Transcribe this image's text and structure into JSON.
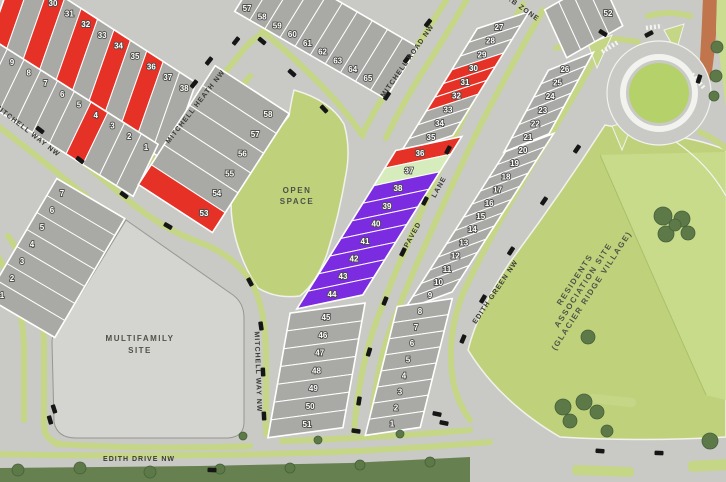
{
  "colors": {
    "red": "#e63226",
    "purple": "#7c2ce0",
    "pale": "#d7ecbc",
    "lot_gray": "#a9a9a6",
    "road_gray": "#c9c9c5",
    "verge_green": "#c5d687",
    "open_green": "#bfd27b",
    "field_light": "#cbdd90",
    "roundabout_green": "#b5d26a",
    "multifamily_gray": "#d4d4d0",
    "orange": "#c0754c",
    "tree_green": "#5e7948",
    "band_green": "#66804f"
  },
  "streets": [
    {
      "id": "mitchell-road-nw",
      "name": "MITCHELL ROAD NW"
    },
    {
      "id": "mitchell-heath-nw",
      "name": "MITCHELL HEATH NW"
    },
    {
      "id": "mitchell-way-nw-west",
      "name": "MITCHELL WAY NW"
    },
    {
      "id": "mitchell-way-nw-south",
      "name": "MITCHELL WAY NW"
    },
    {
      "id": "paved-lane",
      "name": "PAVED LANE"
    },
    {
      "id": "edith-green-nw",
      "name": "EDITH GREEN NW"
    },
    {
      "id": "edith-drive-nw",
      "name": "EDITH DRIVE NW"
    },
    {
      "id": "wb-zone",
      "name": "W.B ZONE"
    }
  ],
  "areas": [
    {
      "id": "open-space",
      "lines": [
        "OPEN",
        "SPACE"
      ]
    },
    {
      "id": "multifamily-site",
      "lines": [
        "MULTIFAMILY",
        "SITE"
      ]
    },
    {
      "id": "residents-association-site",
      "lines": [
        "RESIDENTS",
        "ASSOCIATION SITE",
        "(GLACIER RIDGE VILLAGE)"
      ]
    }
  ],
  "blocks": [
    {
      "id": "block-nw-north",
      "lots": [
        {
          "n": "",
          "c": "red"
        },
        {
          "n": ""
        },
        {
          "n": "30",
          "c": "red"
        },
        {
          "n": "31"
        },
        {
          "n": "32",
          "c": "red"
        },
        {
          "n": "33"
        },
        {
          "n": "34",
          "c": "red"
        },
        {
          "n": "35"
        },
        {
          "n": "36",
          "c": "red"
        },
        {
          "n": "37"
        },
        {
          "n": "38"
        }
      ]
    },
    {
      "id": "block-nw-south",
      "lots": [
        {
          "n": ""
        },
        {
          "n": "9"
        },
        {
          "n": "8"
        },
        {
          "n": "7"
        },
        {
          "n": "6"
        },
        {
          "n": "5"
        },
        {
          "n": "4",
          "c": "red"
        },
        {
          "n": "3"
        },
        {
          "n": "2"
        },
        {
          "n": "1"
        }
      ]
    },
    {
      "id": "block-north-middle",
      "lots": [
        {
          "n": "57"
        },
        {
          "n": "58"
        },
        {
          "n": "59"
        },
        {
          "n": "60"
        },
        {
          "n": "61"
        },
        {
          "n": "62"
        },
        {
          "n": "63"
        },
        {
          "n": "64"
        },
        {
          "n": "65"
        },
        {
          "n": ""
        }
      ]
    },
    {
      "id": "block-heath-east",
      "lots": [
        {
          "n": "58"
        },
        {
          "n": "57"
        },
        {
          "n": "56"
        },
        {
          "n": "55"
        },
        {
          "n": "54"
        },
        {
          "n": "53",
          "c": "red"
        }
      ]
    },
    {
      "id": "block-center-upper",
      "lots": [
        {
          "n": "27"
        },
        {
          "n": "28"
        },
        {
          "n": "29"
        },
        {
          "n": "30",
          "c": "red"
        },
        {
          "n": "31",
          "c": "red"
        },
        {
          "n": "32",
          "c": "red"
        },
        {
          "n": "33"
        },
        {
          "n": "34"
        },
        {
          "n": "35"
        }
      ]
    },
    {
      "id": "block-center-mid",
      "lots": [
        {
          "n": "36",
          "c": "red"
        },
        {
          "n": "37",
          "c": "pale"
        },
        {
          "n": "38",
          "c": "purple"
        },
        {
          "n": "39",
          "c": "purple"
        },
        {
          "n": "40",
          "c": "purple"
        },
        {
          "n": "41",
          "c": "purple"
        },
        {
          "n": "42",
          "c": "purple"
        },
        {
          "n": "43",
          "c": "purple"
        },
        {
          "n": "44",
          "c": "purple"
        }
      ]
    },
    {
      "id": "block-center-lower",
      "lots": [
        {
          "n": "45"
        },
        {
          "n": "46"
        },
        {
          "n": "47"
        },
        {
          "n": "48"
        },
        {
          "n": "49"
        },
        {
          "n": "50"
        },
        {
          "n": "51"
        }
      ]
    },
    {
      "id": "block-east-upper",
      "lots": [
        {
          "n": "26"
        },
        {
          "n": "25"
        },
        {
          "n": "24"
        },
        {
          "n": "23"
        },
        {
          "n": "22"
        },
        {
          "n": "21"
        }
      ]
    },
    {
      "id": "block-east-mid",
      "lots": [
        {
          "n": "20"
        },
        {
          "n": "19"
        },
        {
          "n": "18"
        },
        {
          "n": "17"
        },
        {
          "n": "16"
        },
        {
          "n": "15"
        },
        {
          "n": "14"
        },
        {
          "n": "13"
        },
        {
          "n": "12"
        },
        {
          "n": "11"
        },
        {
          "n": "10"
        },
        {
          "n": "9"
        }
      ]
    },
    {
      "id": "block-east-lower",
      "lots": [
        {
          "n": "8"
        },
        {
          "n": "7"
        },
        {
          "n": "6"
        },
        {
          "n": "5"
        },
        {
          "n": "4"
        },
        {
          "n": "3"
        },
        {
          "n": "2"
        },
        {
          "n": "1"
        }
      ]
    },
    {
      "id": "block-sw",
      "lots": [
        {
          "n": "7"
        },
        {
          "n": "6"
        },
        {
          "n": "5"
        },
        {
          "n": "4"
        },
        {
          "n": "3"
        },
        {
          "n": "2"
        },
        {
          "n": "1"
        }
      ]
    },
    {
      "id": "block-ne-52",
      "lots": [
        {
          "n": "52"
        },
        {
          "n": ""
        },
        {
          "n": ""
        },
        {
          "n": ""
        }
      ]
    }
  ]
}
